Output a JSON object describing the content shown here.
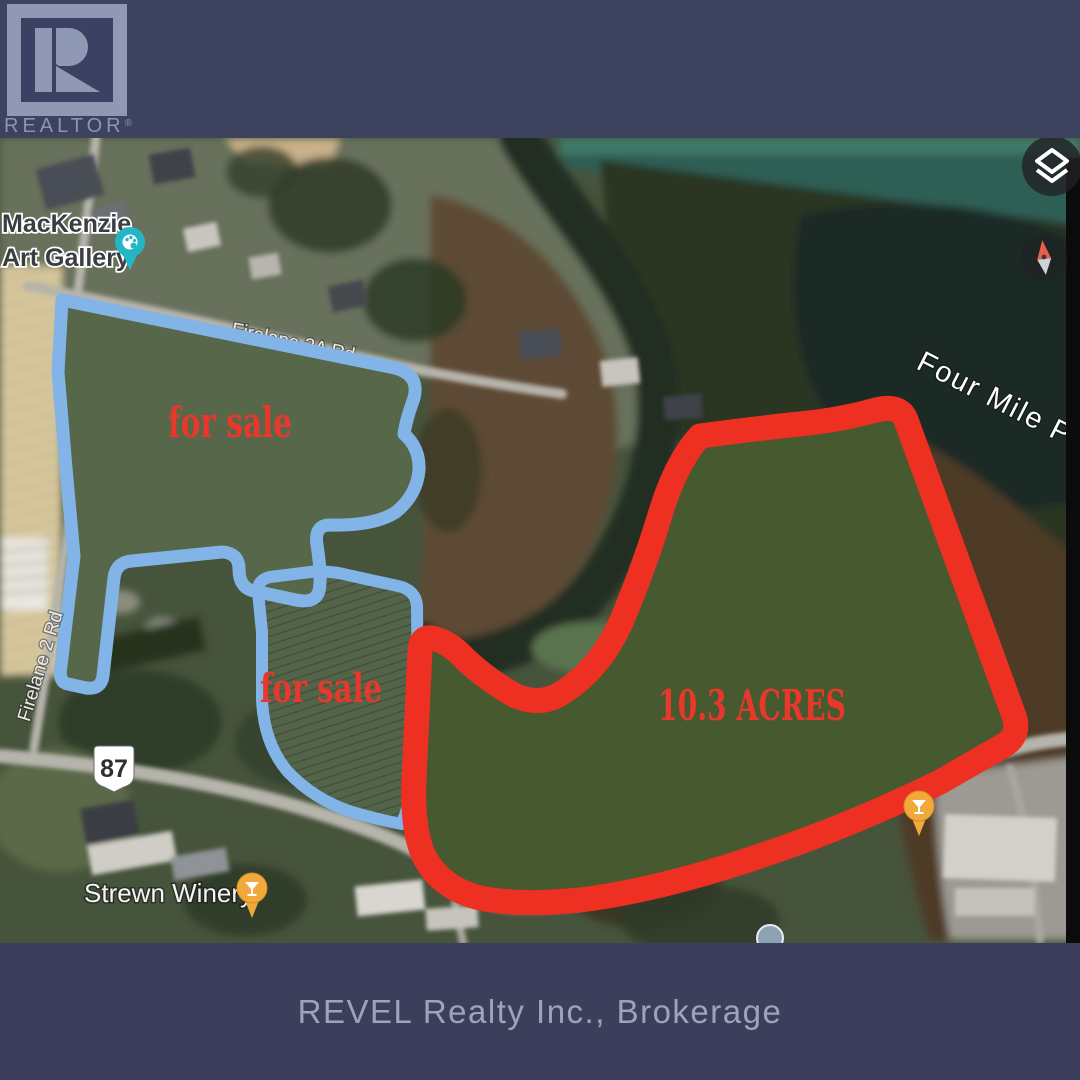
{
  "branding": {
    "logo_text": "REALTOR",
    "registered": "®"
  },
  "footer": {
    "brokerage": "REVEL Realty Inc., Brokerage"
  },
  "map": {
    "poi": {
      "gallery_line1": "MacKenzie",
      "gallery_line2": "Art Gallery",
      "strewn_winery": "Strewn Winery",
      "ironwood_left": "Ironwo",
      "ironwood_right": "House",
      "pond": "Four Mile Pond"
    },
    "roads": {
      "firelane2": "Firelane 2 Rd",
      "firelane2a": "Firelane 2A Rd",
      "route_badge": "87"
    },
    "annotations": {
      "for_sale_1": "for sale",
      "for_sale_2": "for sale",
      "acreage": "10.3 ACRES"
    },
    "icons": {
      "layers_icon": "layers",
      "compass_icon": "compass",
      "gallery_pin_icon": "art-palette-pin",
      "winery_pin_icon": "wine-glass-pin",
      "restaurant_pin_icon": "wine-glass-pin"
    },
    "colors": {
      "parcel_blue": "#82b4e8",
      "parcel_red": "#ee3023",
      "annotation_red": "#e8372b",
      "pin_teal": "#25b6c6",
      "pin_orange": "#f2a93b",
      "band_navy": "#3c405e"
    }
  }
}
